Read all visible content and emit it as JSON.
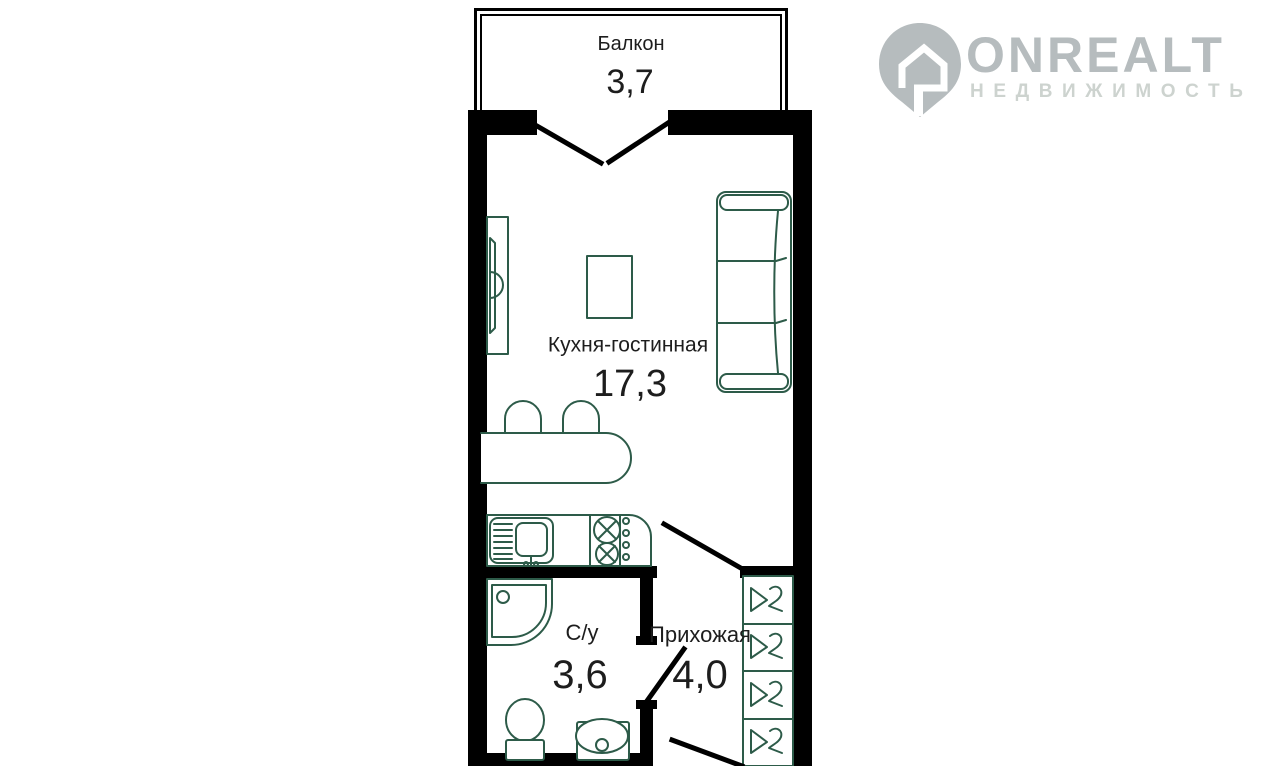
{
  "watermark": {
    "brand": "ONREALT",
    "subtitle": "НЕДВИЖИМОСТЬ"
  },
  "plan": {
    "rooms": [
      {
        "name": "Балкон",
        "area": "3,7"
      },
      {
        "name": "Кухня-гостинная",
        "area": "17,3"
      },
      {
        "name": "С/у",
        "area": "3,6"
      },
      {
        "name": "Прихожая",
        "area": "4,0"
      }
    ],
    "fixtures": [
      "balcony-french-door",
      "tv-stand",
      "coffee-table",
      "sofa-3-seat",
      "bar-counter",
      "bar-stool",
      "bar-stool",
      "kitchen-sink",
      "stove-2-burners",
      "shower-cabin",
      "toilet",
      "washbasin",
      "wardrobe-4-sections-with-hangers",
      "bathroom-door",
      "hallway-door",
      "entrance-door"
    ]
  },
  "colors": {
    "background": "#ffffff",
    "wall": "#000000",
    "furniture": "#2d5b49",
    "label": "#1d1d1d",
    "watermark_primary": "#b6bcbe",
    "watermark_secondary": "#cdd3cf"
  }
}
